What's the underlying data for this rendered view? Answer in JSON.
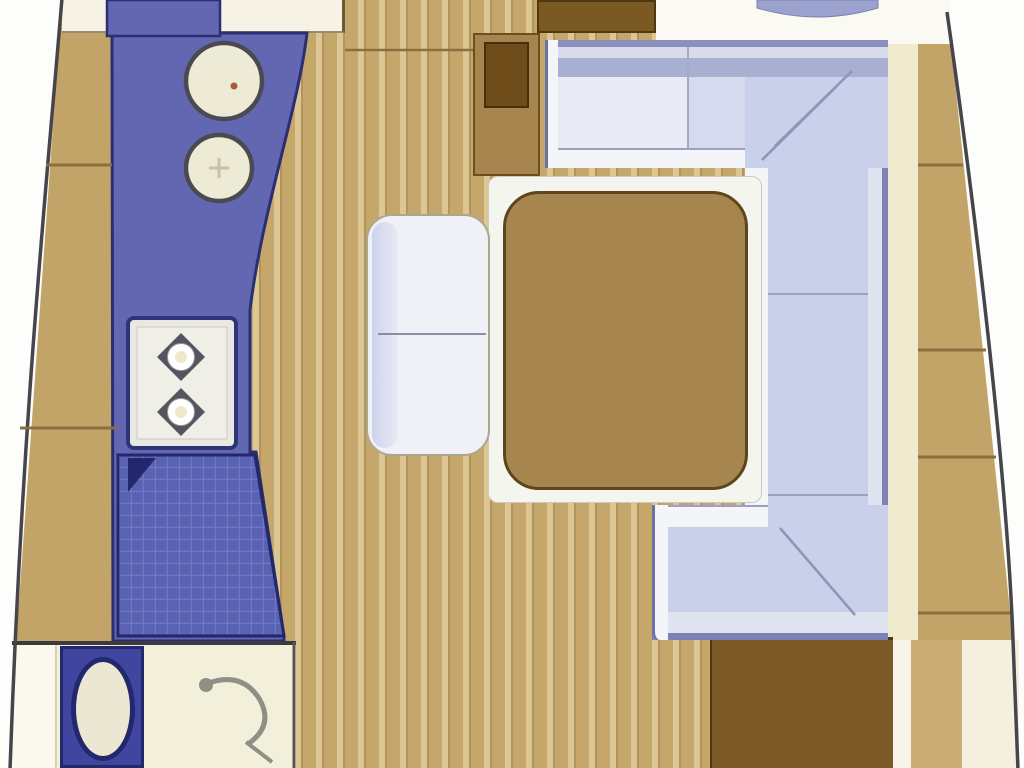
{
  "plan": {
    "type": "yacht-interior-floor-plan",
    "view": "top-down, bow at top",
    "regions": {
      "galley": {
        "label": "Galley counter with twin round sinks, two-burner stove and gridded drainboard",
        "counter_color": "#6367B2",
        "outline_color": "#2B2F72"
      },
      "head": {
        "label": "Head compartment with toilet and shower",
        "floor_color": "#F2EFDA",
        "toilet_panel_color": "#4046A0"
      },
      "dinette": {
        "label": "U-shaped dinette settee around saloon table",
        "cushion_color": "#C9D0EA",
        "trim_color": "#F4F5F9",
        "edge_color": "#7C83B4"
      },
      "table": {
        "label": "Saloon table",
        "top_color": "#A7854E",
        "surround_color": "#F5F5F0"
      },
      "bench": {
        "label": "Two-place bench seat",
        "cushion_color": "#F0F1F6"
      },
      "sole": {
        "label": "Teak plank cabin sole",
        "plank_color": "#C6A76B",
        "stripe_color": "#DCC794"
      },
      "side_decks": {
        "label": "Port and starboard side decks",
        "deck_color": "#C3A468",
        "seam_color": "#8A6E3E"
      },
      "companionway": {
        "label": "Companionway area with locker and mast post",
        "locker_color": "#7A5A22",
        "post_color": "#6F4D1B"
      },
      "aft_locker": {
        "label": "Aft locker / engine box",
        "color": "#7B5A28"
      }
    },
    "features": [
      {
        "name": "galley-sink-icon",
        "count": 2,
        "fill": "#EDEAD6",
        "outline": "#4A4A50"
      },
      {
        "name": "stove-burner-icon",
        "count": 2,
        "fill": "#55555F"
      },
      {
        "name": "drainboard-grid",
        "fill": "#5A62B3",
        "grid_line": "#7077C2"
      },
      {
        "name": "toilet-icon",
        "fill": "#EBE7D2",
        "outline": "#23276B"
      },
      {
        "name": "shower-faucet-icon",
        "stroke": "#8F8F85"
      },
      {
        "name": "hull-outline",
        "stroke": "#45454B"
      }
    ],
    "palette": {
      "background": "#FDFDFB",
      "deck_tan": "#C3A468",
      "cream_strip": "#F0EACE",
      "counter_blue": "#6367B2",
      "navy_outline": "#2B2F72",
      "settee_lavender": "#C9D0EA",
      "table_brown": "#A7854E",
      "dark_wood": "#7A5A22"
    }
  }
}
